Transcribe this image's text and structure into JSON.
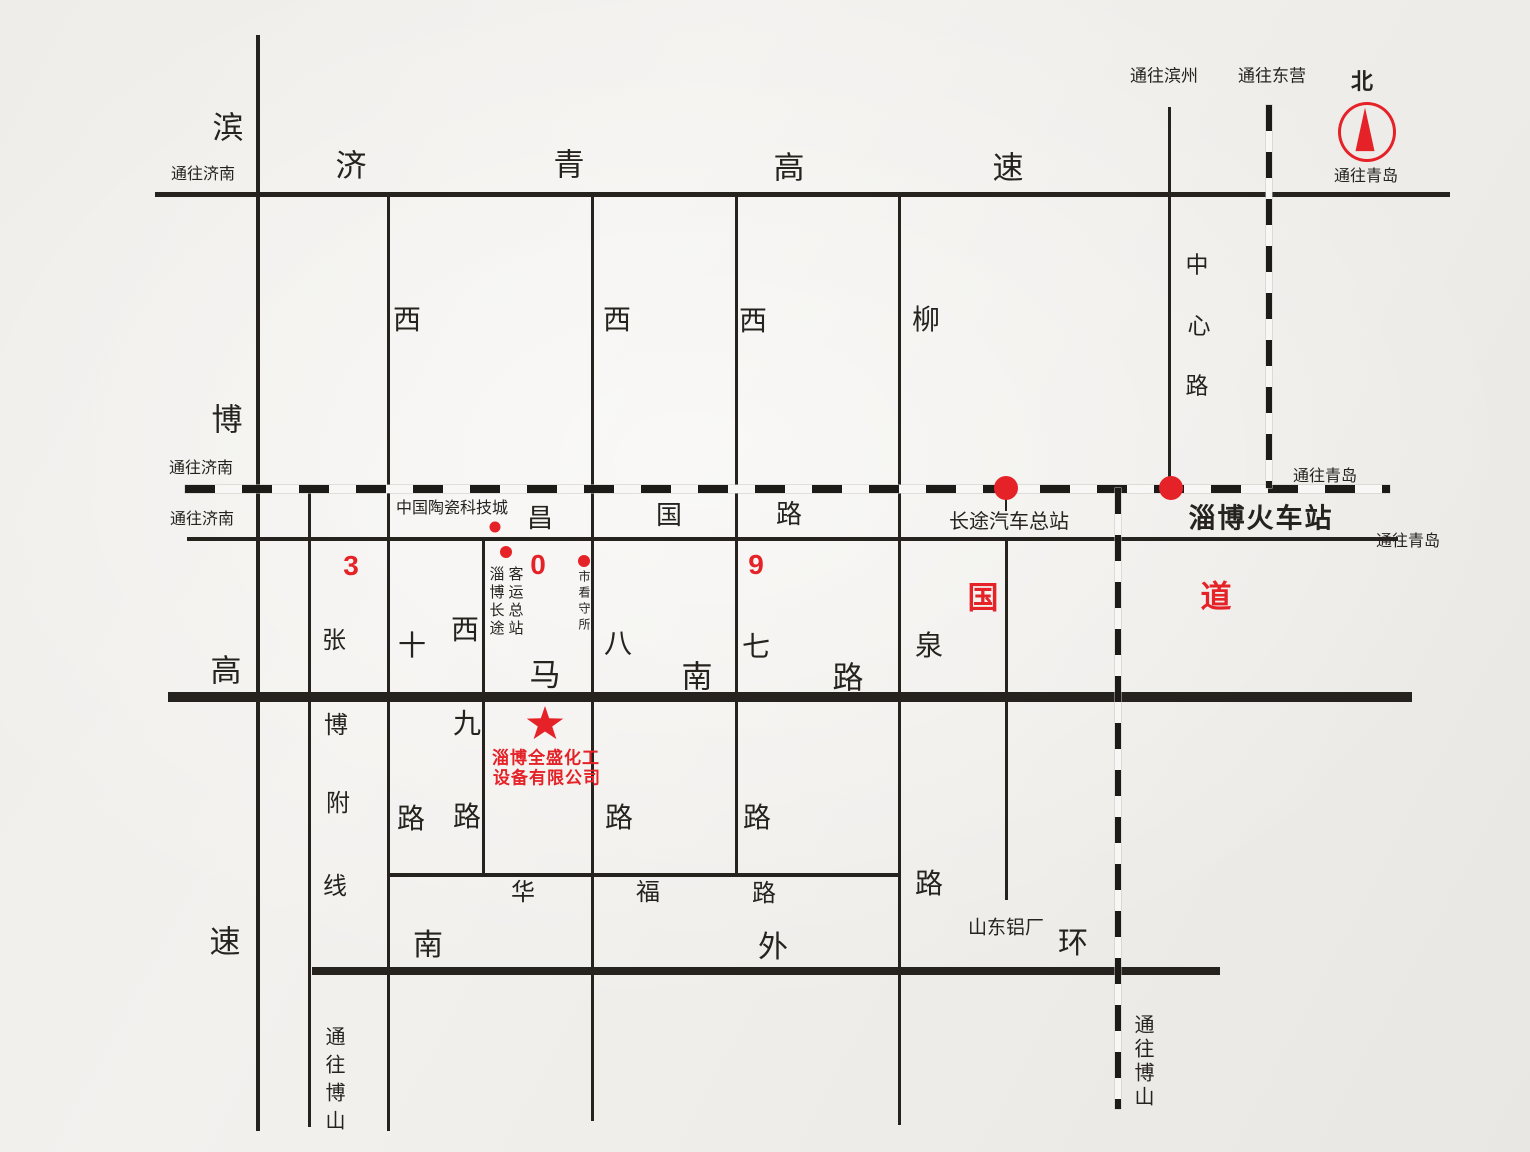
{
  "colors": {
    "red": "#e52228",
    "ink": "#26231f",
    "paper": "#f1efec"
  },
  "compass": {
    "north_label": "北"
  },
  "directions": {
    "to_jinan": "通往济南",
    "to_qingdao": "通往青岛",
    "to_binzhou": "通往滨州",
    "to_dongying": "通往东营",
    "to_boshan": "通往博山"
  },
  "roads": {
    "jiqing_expressway": {
      "name": "济青高速",
      "chars": [
        "济",
        "青",
        "高",
        "速"
      ]
    },
    "binbo_expressway": {
      "name": "滨博高速",
      "chars": [
        "滨",
        "博",
        "高",
        "速"
      ]
    },
    "changguo_road": {
      "name": "昌国路",
      "chars": [
        "昌",
        "国",
        "路"
      ]
    },
    "g309": {
      "name": "309国道",
      "digit_chars": [
        "3",
        "0",
        "9"
      ],
      "suffix_chars": [
        "国",
        "道"
      ]
    },
    "manan_road": {
      "name": "马南路",
      "chars": [
        "马",
        "南",
        "路"
      ]
    },
    "huafu_road": {
      "name": "华福路",
      "chars": [
        "华",
        "福",
        "路"
      ]
    },
    "south_outer_ring": {
      "name": "南外环",
      "chars": [
        "南",
        "外",
        "环"
      ]
    },
    "zhangbo_branch": {
      "name": "张博附线",
      "chars": [
        "张",
        "博",
        "附",
        "线"
      ]
    },
    "xi_shi_road": {
      "name": "西十路",
      "chars": [
        "西",
        "十",
        "路"
      ]
    },
    "xi_jiu_road": {
      "name": "西九路",
      "chars": [
        "西",
        "九",
        "路"
      ]
    },
    "xi_ba_road": {
      "name": "西八路",
      "chars": [
        "西",
        "八",
        "路"
      ]
    },
    "xi_qi_road": {
      "name": "西七路",
      "chars": [
        "西",
        "七",
        "路"
      ]
    },
    "liuquan_road": {
      "name": "柳泉路",
      "chars": [
        "柳",
        "泉",
        "路"
      ]
    },
    "zhongxin_road": {
      "name": "中心路",
      "chars": [
        "中",
        "心",
        "路"
      ]
    }
  },
  "landmarks": {
    "ceramic_tech_city": "中国陶瓷科技城",
    "bus_terminal_col1": "淄博长途",
    "bus_terminal_col2": "客运总站",
    "detention_house": "市看守所",
    "coach_terminal": "长途汽车总站",
    "zibo_railway_station": "淄博火车站",
    "shandong_aluminum": "山东铝厂"
  },
  "company": {
    "line1": "淄博全盛化工",
    "line2": "设备有限公司"
  }
}
